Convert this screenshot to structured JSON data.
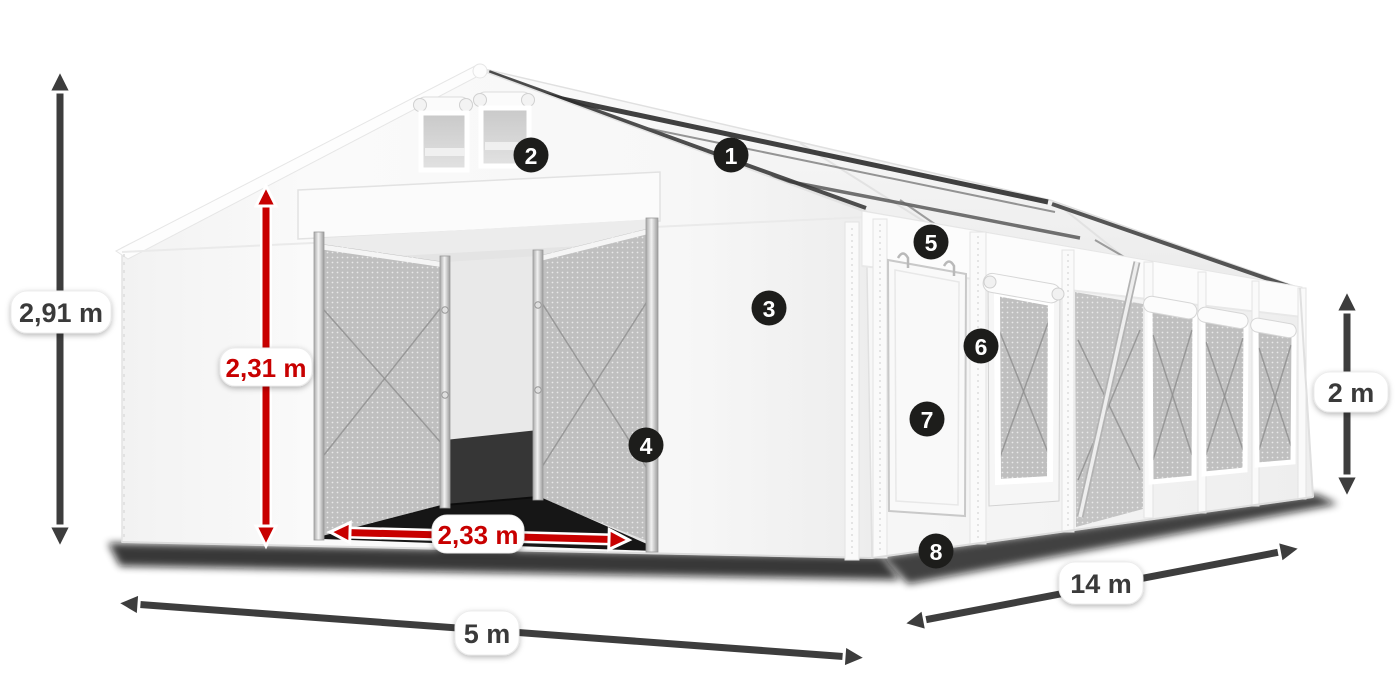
{
  "dimensions": {
    "total_height": {
      "label": "2,91 m"
    },
    "entrance_height": {
      "label": "2,31 m"
    },
    "entrance_width": {
      "label": "2,33 m"
    },
    "width": {
      "label": "5 m"
    },
    "length": {
      "label": "14 m"
    },
    "side_height": {
      "label": "2 m"
    }
  },
  "callouts": [
    {
      "number": "1"
    },
    {
      "number": "2"
    },
    {
      "number": "3"
    },
    {
      "number": "4"
    },
    {
      "number": "5"
    },
    {
      "number": "6"
    },
    {
      "number": "7"
    },
    {
      "number": "8"
    }
  ],
  "colors": {
    "dimension_arrow_dark": "#3d3d3d",
    "dimension_arrow_red": "#c80000",
    "label_pill_background": "#ffffff",
    "label_text_dark": "#3a3a3a",
    "label_text_red": "#c80000",
    "callout_background": "#1d1d1b",
    "callout_text": "#ffffff",
    "tent_canvas": "#f6f6f6",
    "mesh_panel": "#bfbfbf"
  }
}
